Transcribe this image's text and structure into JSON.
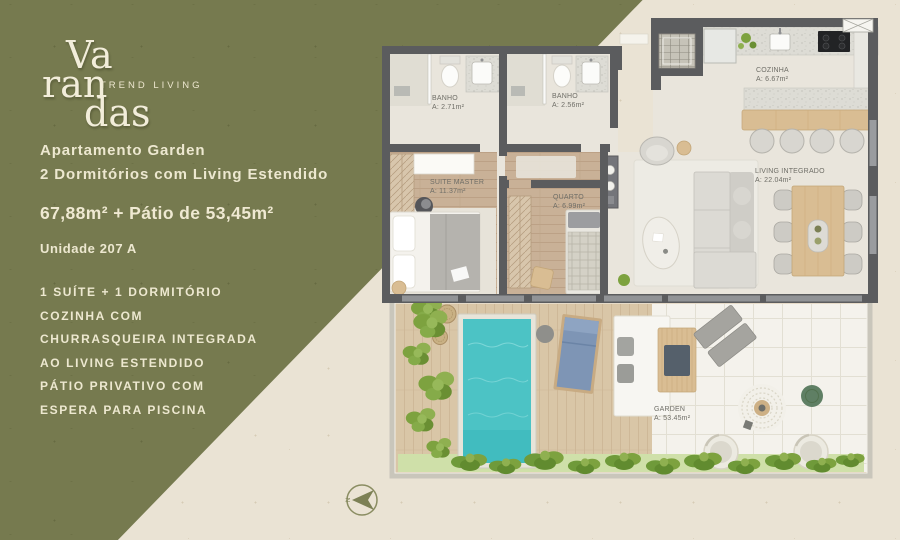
{
  "brand": {
    "word_top": "Va",
    "word_mid": "ran",
    "word_bottom": "das",
    "tagline": "TREND LIVING"
  },
  "panel": {
    "heading_line1": "Apartamento Garden",
    "heading_line2": "2 Dormitórios com Living Estendido",
    "area_summary": "67,88m² + Pátio de 53,45m²",
    "unit_label": "Unidade 207 A",
    "features": [
      "1 SUÍTE + 1 DORMITÓRIO",
      "COZINHA COM",
      "CHURRASQUEIRA INTEGRADA",
      "AO LIVING ESTENDIDO",
      "PÁTIO PRIVATIVO COM",
      "ESPERA PARA PISCINA"
    ]
  },
  "floorplan": {
    "rooms": [
      {
        "id": "banho1",
        "name": "BANHO",
        "area": "A: 2.71m²"
      },
      {
        "id": "banho2",
        "name": "BANHO",
        "area": "A: 2.56m²"
      },
      {
        "id": "suite_master",
        "name": "SUITE MASTER",
        "area": "A: 11.37m²"
      },
      {
        "id": "quarto",
        "name": "QUARTO",
        "area": "A: 6.99m²"
      },
      {
        "id": "cozinha",
        "name": "COZINHA",
        "area": "A: 6.67m²"
      },
      {
        "id": "living",
        "name": "LIVING INTEGRADO",
        "area": "A: 22.04m²"
      },
      {
        "id": "garden",
        "name": "GARDEN",
        "area": "A: 53.45m²"
      }
    ],
    "compass_label": "N"
  },
  "colors": {
    "panel_green": "#767A4F",
    "background_beige": "#EAE3D4",
    "cream_text": "#EFE9D2",
    "wall_gray": "#5B5C5E",
    "pool_turquoise": "#4CC3C5",
    "bedroom_wood": "#C9B197",
    "deck_wood": "#D9C6A7",
    "bar_wood": "#D9BD93",
    "plant_green": "#7DA23F"
  }
}
